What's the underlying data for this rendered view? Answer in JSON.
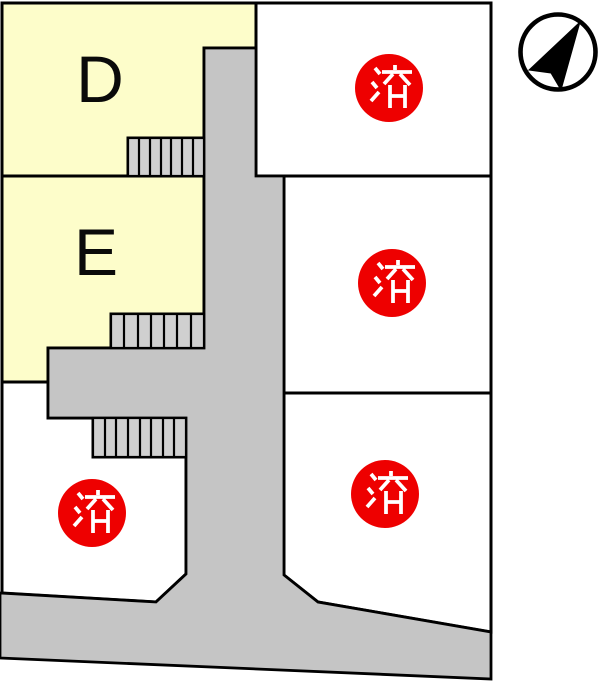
{
  "map": {
    "plots": [
      {
        "id": "d",
        "label": "D"
      },
      {
        "id": "e",
        "label": "E"
      }
    ],
    "sold_stamp_text": "済",
    "sold_stamp_count": 4
  },
  "compass": {
    "label": "north-arrow"
  },
  "colors": {
    "available_fill": "#fdfdca",
    "plot_fill": "#ffffff",
    "road_fill": "#c5c5c5",
    "stairs_fill": "#d0d0d0",
    "line": "#000000",
    "sold_red": "#ee0000",
    "stamp_text": "#ffffff"
  }
}
